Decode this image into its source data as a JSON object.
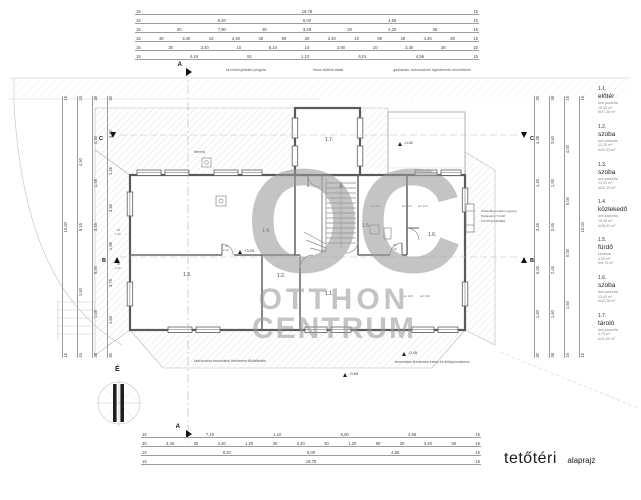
{
  "drawing_title": {
    "main": "tetőtéri",
    "sub": "alaprajz"
  },
  "watermark": {
    "top": "OC",
    "mid": "OTTHON",
    "bottom": "CENTRUM"
  },
  "notes": {
    "pergola": "fa növényfuttató pergola",
    "velux": "Velux tetősík ablak",
    "boiler": "gázkazán, turbócsöves égéstermék elvezetővel",
    "firewall": "kétvízorros bevonatos fémlemez tűzfalfedés",
    "eaves": "bevonatos fémlemez eresz és lefolyócsatorna",
    "chimney": "kémény",
    "north": "É"
  },
  "heat_pump": {
    "line1": "hőszivattyú kültéri egység",
    "line2": "Panasonic T-CAP",
    "line3": "KIT-WXC16H9E8"
  },
  "levels": {
    "attic": "+3,00",
    "terrace": "-0,02",
    "eave_a": "-0,45",
    "eave_b": "-0,60"
  },
  "sections": {
    "a": "A",
    "b": "B",
    "c": "C"
  },
  "plan": {
    "room_labels": {
      "r11": "1.1.",
      "r12": "1.2.",
      "r13": "1.3.",
      "r14": "1.4.",
      "r15": "1.5.",
      "r16": "1.6.",
      "r17": "1.7."
    },
    "door_dim_width": "90",
    "door_dim_height": "2,10",
    "door_dim_height2": "1,20",
    "window_parapet": "pm 110"
  },
  "dims": {
    "top_rows": [
      [
        "15",
        "18,78",
        "15"
      ],
      [
        "15",
        "8,20",
        "6,00",
        "4,58",
        "15"
      ],
      [
        "15",
        "30",
        "7,90",
        "30",
        "3,40",
        "30",
        "4,20",
        "38",
        "15"
      ],
      [
        "15",
        "30",
        "3,40",
        "10",
        "4,40",
        "30",
        "90",
        "30",
        "3,40",
        "10",
        "90",
        "30",
        "4,20",
        "38",
        "15"
      ],
      [
        "15",
        "30",
        "3,40",
        "10",
        "8,10",
        "10",
        "2,90",
        "10",
        "3,40",
        "38",
        "15"
      ],
      [
        "15",
        "4,19",
        "91",
        "1,10",
        "6,01",
        "4,56",
        "15"
      ]
    ],
    "bottom_rows": [
      [
        "15",
        "7,10",
        "1,10",
        "6,00",
        "4,58",
        "15"
      ],
      [
        "30",
        "3,40",
        "30",
        "4,40",
        "1,20",
        "30",
        "3,40",
        "30",
        "1,20",
        "90",
        "30",
        "3,40",
        "38",
        "15"
      ],
      [
        "15",
        "8,20",
        "6,00",
        "4,58",
        "15"
      ],
      [
        "15",
        "18,78",
        "15"
      ]
    ],
    "left_cols": [
      [
        "15",
        "15,00",
        "15"
      ],
      [
        "15",
        "4,50",
        "9,15",
        "1,60",
        "15"
      ],
      [
        "38",
        "4,20",
        "1,45",
        "3,45",
        "5,00",
        "1,05",
        "38"
      ],
      [
        "30",
        "3,40",
        "1,45",
        "3,35",
        "1,95",
        "3,75",
        "1,60",
        "30"
      ]
    ],
    "right_cols": [
      [
        "30",
        "4,38",
        "1,40",
        "3,45",
        "5,00",
        "1,60",
        "30"
      ],
      [
        "38",
        "3,60",
        "1,00",
        "3,45",
        "2,45",
        "1,60",
        "38"
      ],
      [
        "15",
        "4,00",
        "6,00",
        "5,00",
        "1,60",
        "15"
      ],
      [
        "15",
        "15,00",
        "15"
      ]
    ]
  },
  "legend": {
    "rows": [
      {
        "no": "1.1.",
        "name": "előtér",
        "floor": "lam.parketta",
        "net": "16,43 m²",
        "gross": "br27,36 m²"
      },
      {
        "no": "1.2.",
        "name": "szoba",
        "floor": "lam.parketta",
        "net": "12,25 m²",
        "gross": "br20,33 m²"
      },
      {
        "no": "1.3.",
        "name": "szoba",
        "floor": "lam.parketta",
        "net": "13,04 m²",
        "gross": "br22,10 m²"
      },
      {
        "no": "1.4.",
        "name": "közlekedő",
        "floor": "lam.parketta",
        "net": "15,38 m²",
        "gross": "br28,02 m²"
      },
      {
        "no": "1.5.",
        "name": "fürdő",
        "floor": "kerámia",
        "net": "4,93 m²",
        "gross": "br8,70 m²"
      },
      {
        "no": "1.6.",
        "name": "szoba",
        "floor": "lam.parketta",
        "net": "13,43 m²",
        "gross": "br22,28 m²"
      },
      {
        "no": "1.7.",
        "name": "tároló",
        "floor": "lam.parketta",
        "net": "4,75 m²",
        "gross": "br11,90 m²"
      }
    ]
  }
}
